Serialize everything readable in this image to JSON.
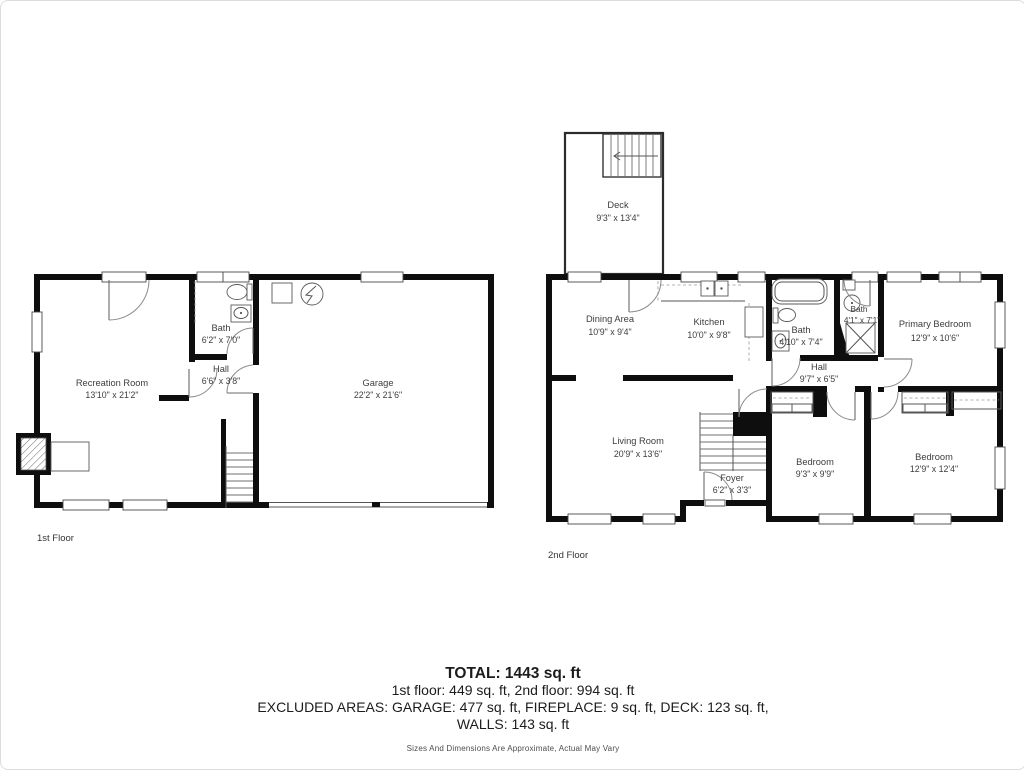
{
  "first_floor": {
    "label": "1st Floor",
    "rooms": {
      "recreation": {
        "name": "Recreation Room",
        "dims": "13'10\" x 21'2\""
      },
      "bath": {
        "name": "Bath",
        "dims": "6'2\" x 7'0\""
      },
      "hall": {
        "name": "Hall",
        "dims": "6'6\" x 3'8\""
      },
      "garage": {
        "name": "Garage",
        "dims": "22'2\" x 21'6\""
      }
    }
  },
  "second_floor": {
    "label": "2nd Floor",
    "rooms": {
      "deck": {
        "name": "Deck",
        "dims": "9'3\" x 13'4\""
      },
      "dining": {
        "name": "Dining Area",
        "dims": "10'9\" x 9'4\""
      },
      "kitchen": {
        "name": "Kitchen",
        "dims": "10'0\" x 9'8\""
      },
      "bath_main": {
        "name": "Bath",
        "dims": "4'10\" x 7'4\""
      },
      "bath_small": {
        "name": "Bath",
        "dims": "4'1\" x 7'1\""
      },
      "primary_bedroom": {
        "name": "Primary Bedroom",
        "dims": "12'9\" x 10'6\""
      },
      "hall": {
        "name": "Hall",
        "dims": "9'7\" x 6'5\""
      },
      "living": {
        "name": "Living Room",
        "dims": "20'9\" x 13'6\""
      },
      "foyer": {
        "name": "Foyer",
        "dims": "6'2\" x 3'3\""
      },
      "bedroom_a": {
        "name": "Bedroom",
        "dims": "9'3\" x 9'9\""
      },
      "bedroom_b": {
        "name": "Bedroom",
        "dims": "12'9\" x 12'4\""
      }
    }
  },
  "summary": {
    "total": "TOTAL: 1443 sq. ft",
    "floors_line": "1st floor: 449 sq. ft, 2nd floor: 994 sq. ft",
    "excluded_line": "EXCLUDED AREAS: GARAGE: 477 sq. ft, FIREPLACE: 9 sq. ft, DECK: 123 sq. ft,",
    "walls_line": "WALLS: 143 sq. ft",
    "disclaimer": "Sizes And Dimensions Are Approximate, Actual May Vary"
  },
  "colors": {
    "wall": "#0e0e0e",
    "text": "#3d3d3d",
    "background": "#ffffff"
  }
}
